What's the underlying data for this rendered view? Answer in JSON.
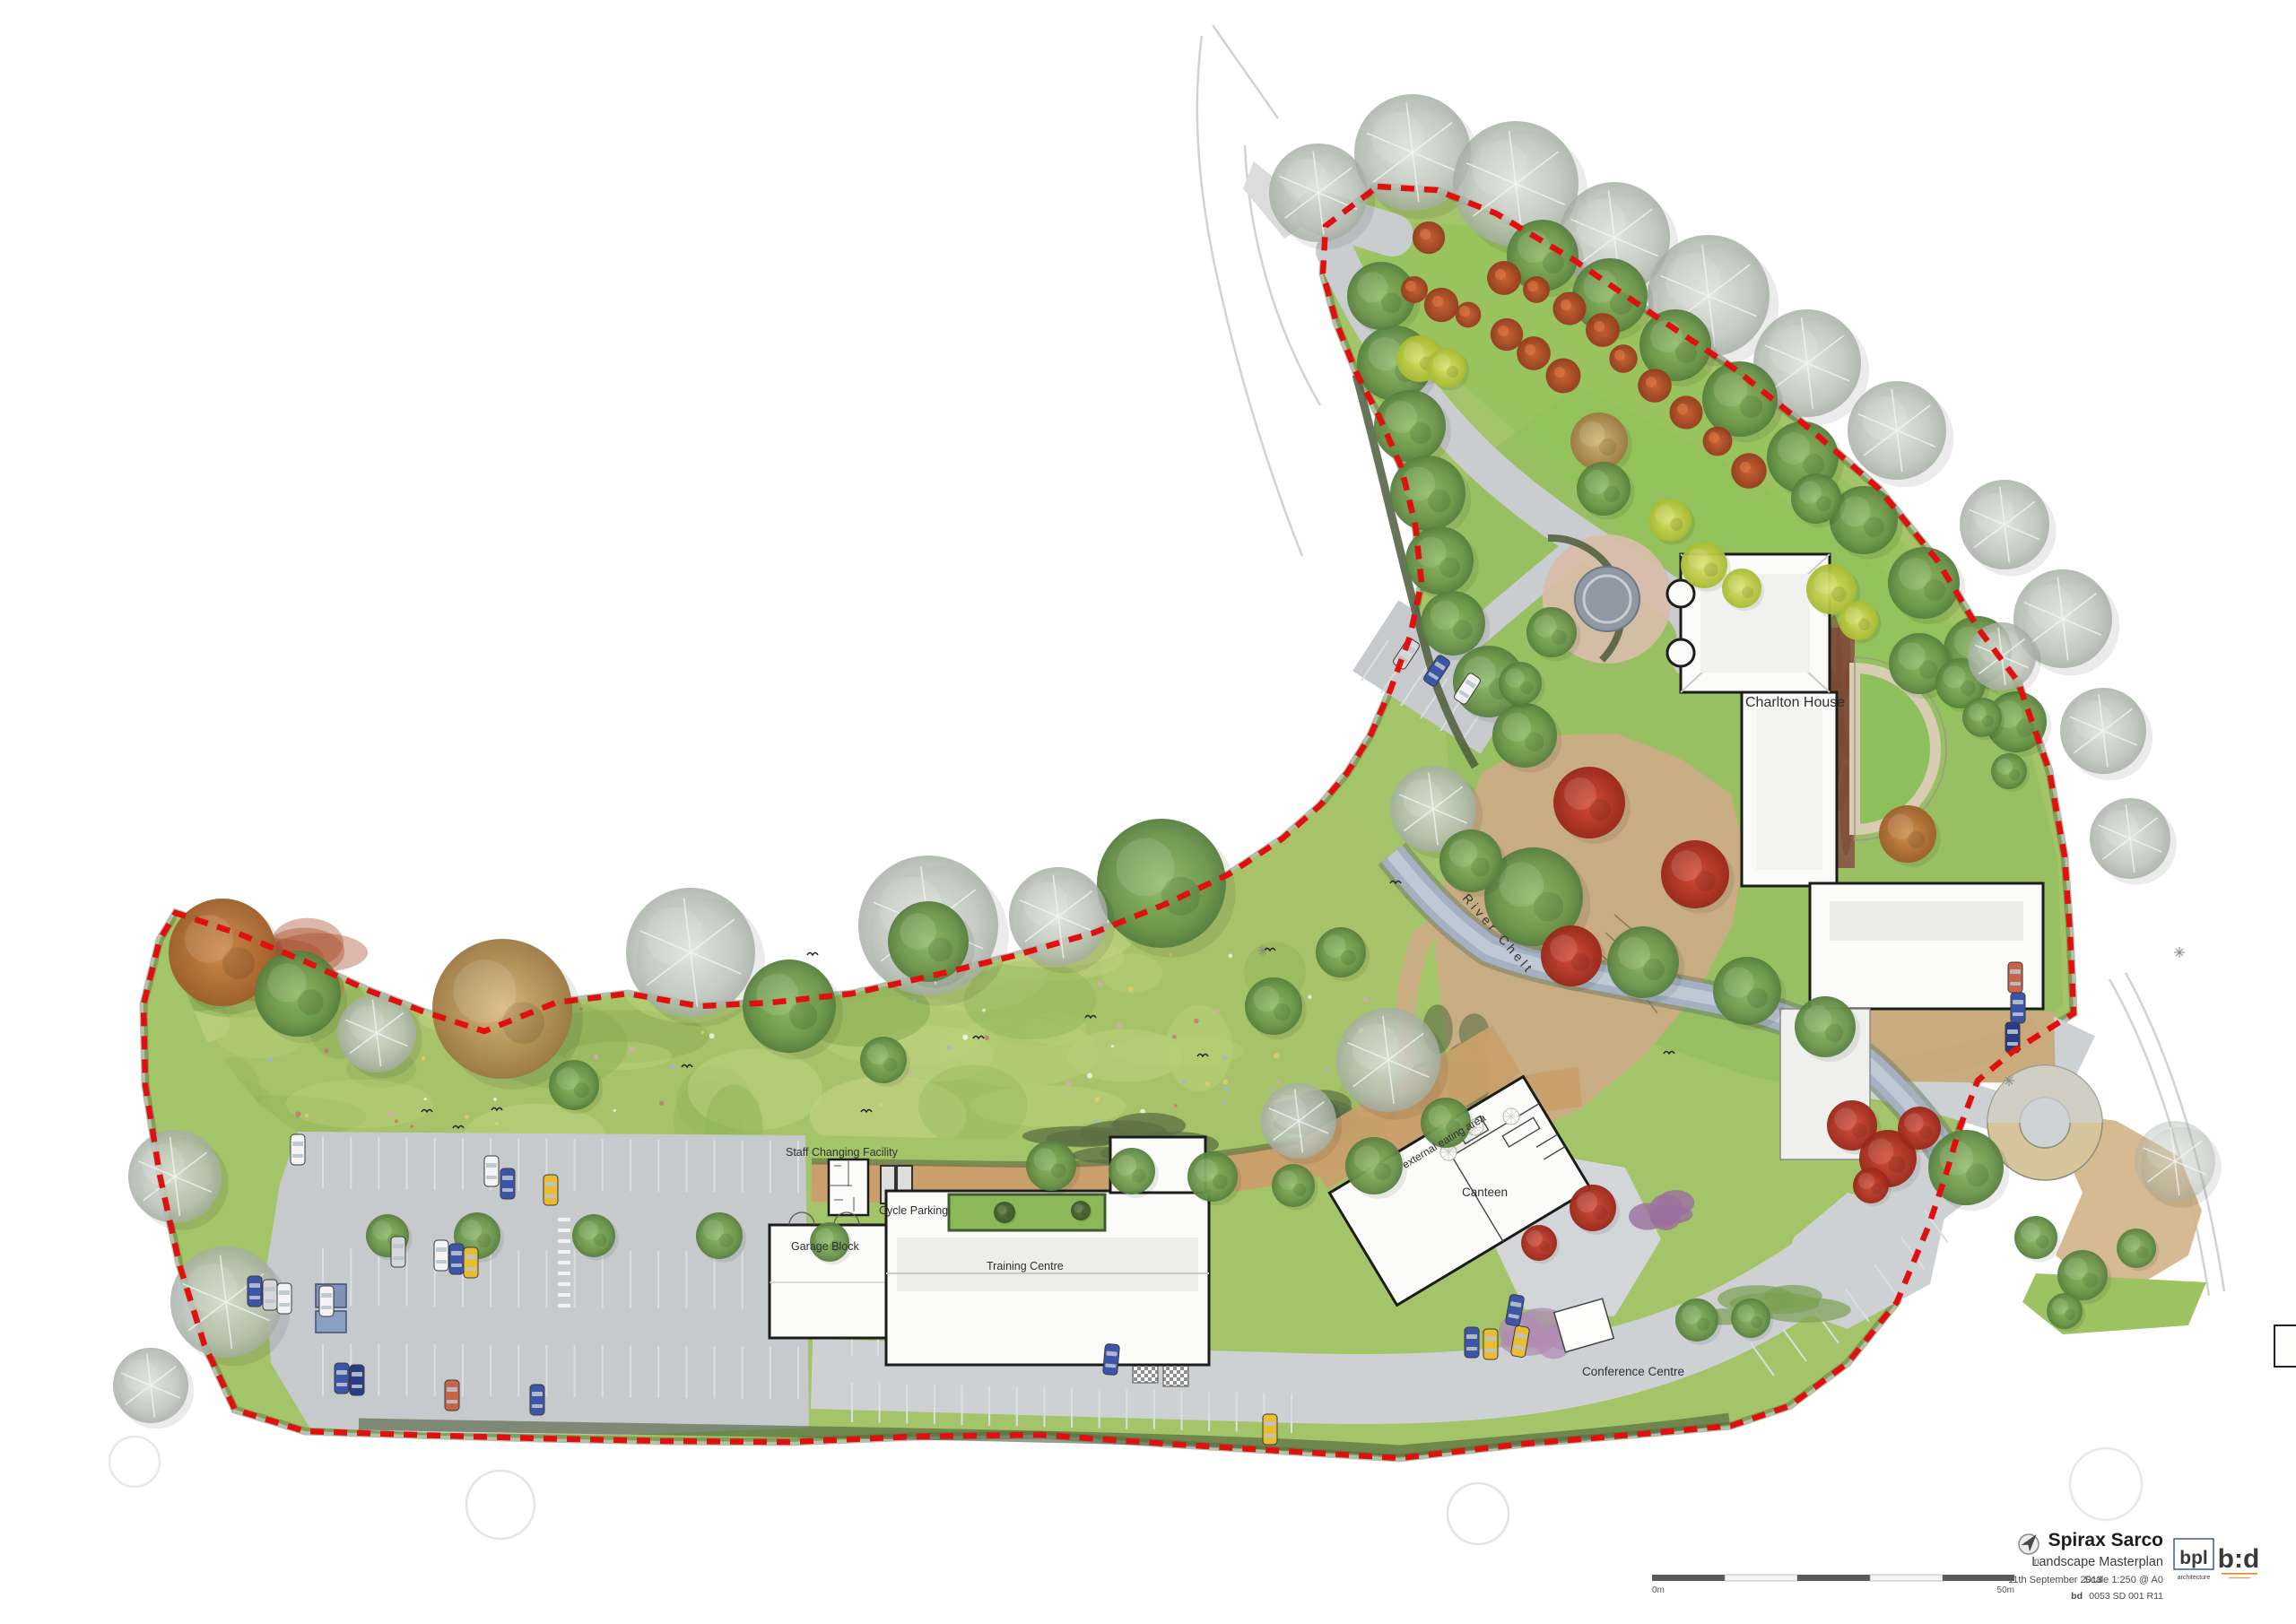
{
  "plan_labels": {
    "charlton_house": "Charlton House",
    "river": "River Chelt",
    "staff_changing": "Staff Changing Facility",
    "cycle_parking": "Cycle Parking",
    "garage_block": "Garage Block",
    "training_centre": "Training Centre",
    "canteen": "Canteen",
    "external_eating": "external eating area",
    "conference_centre": "Conference Centre"
  },
  "title_block": {
    "client": "Spirax Sarco",
    "drawing_title": "Landscape Masterplan",
    "date": "11th September 2013",
    "scale": "Scale 1:250 @ A0",
    "drawing_number_prefix": "bd",
    "drawing_number": "0053 SD 001 R11",
    "north_label": "n"
  },
  "scale_bar": {
    "zero_label": "0m",
    "end_label": "50m"
  },
  "logos": {
    "bpl_text": "bpl",
    "bpl_subtext": "architecture",
    "bd_text": "b:d"
  },
  "colors": {
    "boundary_red": "#e01010",
    "bpl_blue": "#2b4ea2",
    "bd_orange": "#f08218"
  }
}
